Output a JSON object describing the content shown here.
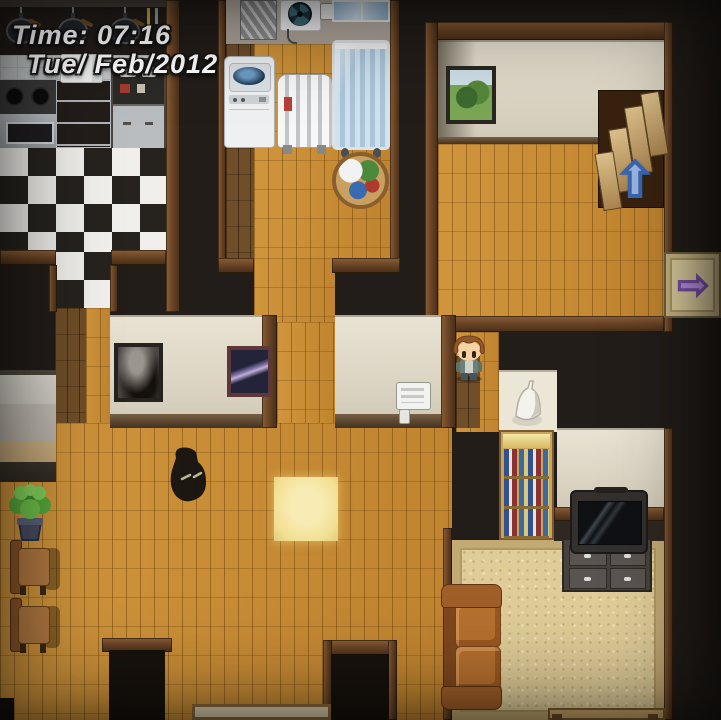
{
  "hud": {
    "time_label": "Time: 07:16",
    "date_label": "Tue/ Feb/2012"
  },
  "icons": {
    "stairs_up_arrow": {
      "glyph": "⬆",
      "meaning": "stairs go up"
    },
    "exit_right_arrow": {
      "glyph": "➡",
      "meaning": "exit to the right"
    }
  },
  "colors": {
    "void": "#221d19",
    "oak": "#c98c33",
    "walnut": "#6f4e29",
    "checker_dark": "#26231f",
    "checker_light": "#f1efeb",
    "carpet": "#dfcc98",
    "carpet_border": "#c3aa72",
    "yellow_tile": "#f2df92",
    "blue_arrow": "#9cb4e4",
    "blue_arrow_dark": "#3a66ae",
    "purple_arrow": "#b991dd",
    "purple_arrow_dark": "#7a4fa8",
    "hud": "#ffffff"
  }
}
